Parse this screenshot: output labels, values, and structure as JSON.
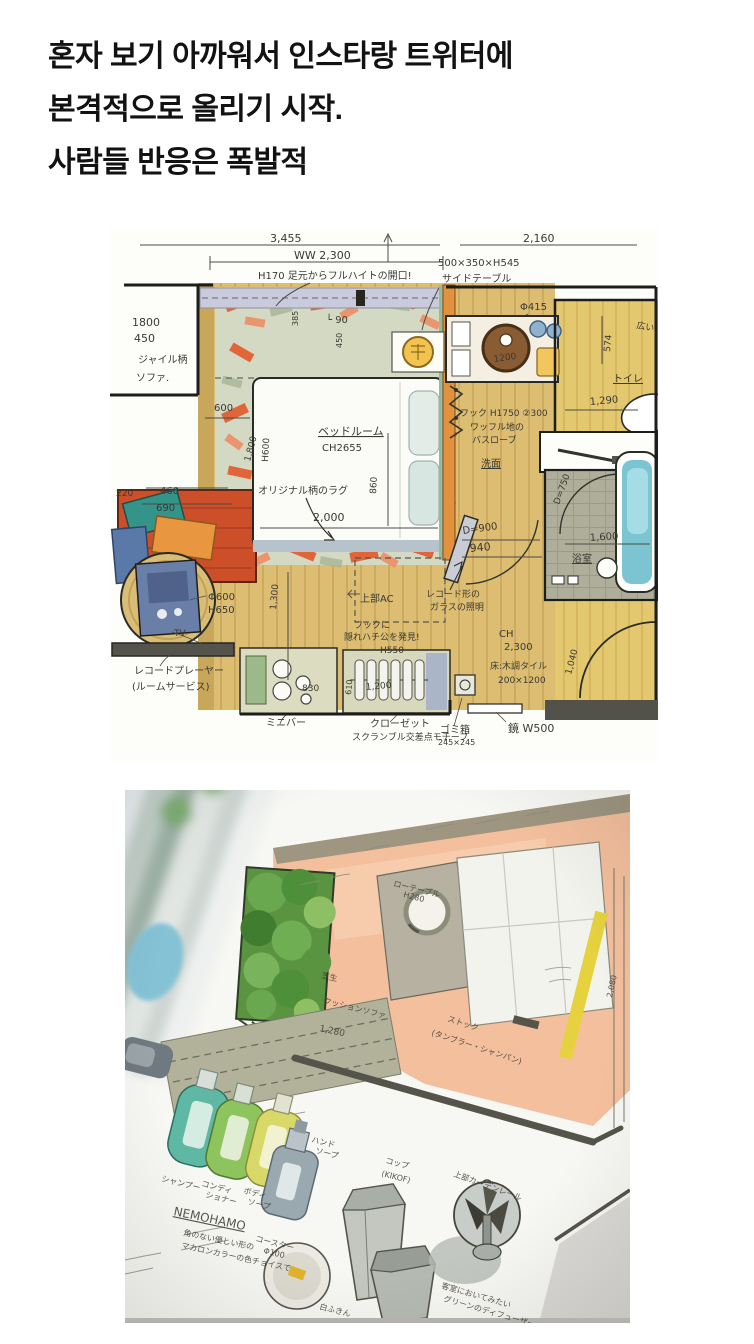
{
  "post": {
    "lines": [
      "혼자 보기 아까워서 인스타랑 트위터에",
      "본격적으로 올리기 시작.",
      "사람들 반응은 폭발적"
    ],
    "text_color": "#121212"
  },
  "plan1": {
    "description": "watercolor hotel guest-room floor plan, top-down",
    "palette": {
      "wood": "#dcbd72",
      "toilet_wood": "#e4c86f",
      "window_band": "#c9cbdc",
      "rug_base": "#d4d9c4",
      "rug_orange": "#e2592a",
      "sofa_red": "#cc4f2a",
      "tub_blue": "#7cc4d2",
      "tile": "#aeae9a",
      "stool_yellow": "#f2c65f",
      "player_blue": "#6a7fa8",
      "ink": "#2b2b26"
    },
    "annotations": [
      {
        "t": "3,455",
        "x": 160,
        "y": 14,
        "s": 11
      },
      {
        "t": "2,160",
        "x": 413,
        "y": 14,
        "s": 11
      },
      {
        "t": "WW 2,300",
        "x": 184,
        "y": 31,
        "s": 11
      },
      {
        "t": "500×350×H545",
        "x": 328,
        "y": 38,
        "s": 10
      },
      {
        "t": "サイドテーブル",
        "x": 332,
        "y": 54,
        "s": 10
      },
      {
        "t": "H170 足元からフルハイトの開口!",
        "x": 148,
        "y": 51,
        "s": 10
      },
      {
        "t": "385",
        "x": 188,
        "y": 98,
        "s": 8,
        "r": -90
      },
      {
        "t": "└ 90",
        "x": 216,
        "y": 95,
        "s": 10
      },
      {
        "t": "450",
        "x": 232,
        "y": 120,
        "s": 8,
        "r": -90
      },
      {
        "t": "1800",
        "x": 22,
        "y": 98,
        "s": 11
      },
      {
        "t": "450",
        "x": 24,
        "y": 114,
        "s": 11
      },
      {
        "t": "ジャイル柄",
        "x": 28,
        "y": 135,
        "s": 10
      },
      {
        "t": "ソファ.",
        "x": 26,
        "y": 153,
        "s": 10
      },
      {
        "t": "Φ415",
        "x": 410,
        "y": 82,
        "s": 10
      },
      {
        "t": "1200",
        "x": 384,
        "y": 134,
        "s": 9,
        "r": -8
      },
      {
        "t": "574",
        "x": 500,
        "y": 124,
        "s": 9,
        "r": -85
      },
      {
        "t": "広い",
        "x": 526,
        "y": 100,
        "s": 9,
        "r": 10
      },
      {
        "t": "トイレ",
        "x": 503,
        "y": 154,
        "s": 10,
        "u": 1
      },
      {
        "t": "1,290",
        "x": 480,
        "y": 177,
        "s": 10,
        "r": -5
      },
      {
        "t": "フック H1750 ②300",
        "x": 350,
        "y": 188,
        "s": 9
      },
      {
        "t": "ワッフル地の",
        "x": 360,
        "y": 202,
        "s": 9
      },
      {
        "t": "バスローブ",
        "x": 362,
        "y": 215,
        "s": 9
      },
      {
        "t": "洗面",
        "x": 371,
        "y": 239,
        "s": 10,
        "u": 1
      },
      {
        "t": "600",
        "x": 104,
        "y": 183,
        "s": 10
      },
      {
        "t": "1,800",
        "x": 140,
        "y": 234,
        "s": 9,
        "r": -75
      },
      {
        "t": "H600",
        "x": 158,
        "y": 234,
        "s": 9,
        "r": -87
      },
      {
        "t": "ベッドルーム",
        "x": 208,
        "y": 207,
        "s": 11,
        "u": 1
      },
      {
        "t": "CH2655",
        "x": 212,
        "y": 223,
        "s": 10
      },
      {
        "t": "860",
        "x": 266,
        "y": 266,
        "s": 9,
        "r": -87
      },
      {
        "t": "オリジナル柄のラグ",
        "x": 148,
        "y": 266,
        "s": 10
      },
      {
        "t": "2,000",
        "x": 203,
        "y": 293,
        "s": 11
      },
      {
        "t": "220",
        "x": 6,
        "y": 268,
        "s": 9
      },
      {
        "t": "460",
        "x": 50,
        "y": 266,
        "s": 10
      },
      {
        "t": "690",
        "x": 46,
        "y": 283,
        "s": 10
      },
      {
        "t": "Φ600",
        "x": 98,
        "y": 372,
        "s": 10
      },
      {
        "t": "H650",
        "x": 98,
        "y": 385,
        "s": 10
      },
      {
        "t": "TV",
        "x": 64,
        "y": 408,
        "s": 9
      },
      {
        "t": "レコードプレーヤー",
        "x": 24,
        "y": 446,
        "s": 10
      },
      {
        "t": "(ルームサービス)",
        "x": 22,
        "y": 462,
        "s": 10
      },
      {
        "t": "830",
        "x": 192,
        "y": 463,
        "s": 9
      },
      {
        "t": "ミニバー",
        "x": 156,
        "y": 498,
        "s": 10
      },
      {
        "t": "1,300",
        "x": 166,
        "y": 382,
        "s": 9,
        "r": -85
      },
      {
        "t": "上部AC",
        "x": 250,
        "y": 374,
        "s": 10
      },
      {
        "t": "フックに",
        "x": 244,
        "y": 400,
        "s": 9
      },
      {
        "t": "隠れハチ公を発見!",
        "x": 234,
        "y": 412,
        "s": 9
      },
      {
        "t": "H550",
        "x": 270,
        "y": 425,
        "s": 9
      },
      {
        "t": "610",
        "x": 241,
        "y": 467,
        "s": 8,
        "r": -85
      },
      {
        "t": "1,200",
        "x": 256,
        "y": 462,
        "s": 9,
        "r": -5
      },
      {
        "t": "クローゼット",
        "x": 260,
        "y": 499,
        "s": 10
      },
      {
        "t": "スクランブル交差点モチーフ",
        "x": 242,
        "y": 512,
        "s": 9
      },
      {
        "t": "ゴミ箱",
        "x": 330,
        "y": 505,
        "s": 10
      },
      {
        "t": "245×245",
        "x": 328,
        "y": 517,
        "s": 8
      },
      {
        "t": "鏡 W500",
        "x": 398,
        "y": 504,
        "s": 11
      },
      {
        "t": "CH",
        "x": 389,
        "y": 409,
        "s": 10
      },
      {
        "t": "2,300",
        "x": 394,
        "y": 422,
        "s": 10
      },
      {
        "t": "床:木調タイル",
        "x": 380,
        "y": 441,
        "s": 9
      },
      {
        "t": "200×1200",
        "x": 388,
        "y": 455,
        "s": 9
      },
      {
        "t": "1,040",
        "x": 461,
        "y": 447,
        "s": 9,
        "r": -75
      },
      {
        "t": "D=900",
        "x": 353,
        "y": 306,
        "s": 10,
        "r": -8
      },
      {
        "t": "940",
        "x": 360,
        "y": 324,
        "s": 11,
        "r": -5
      },
      {
        "t": "レコード形の",
        "x": 316,
        "y": 369,
        "s": 9
      },
      {
        "t": "ガラスの照明",
        "x": 320,
        "y": 382,
        "s": 9
      },
      {
        "t": "D=750",
        "x": 449,
        "y": 277,
        "s": 9,
        "r": -70
      },
      {
        "t": "1,600",
        "x": 480,
        "y": 313,
        "s": 10,
        "r": -4
      },
      {
        "t": "浴室",
        "x": 462,
        "y": 334,
        "s": 10,
        "u": 1
      }
    ]
  },
  "plan2": {
    "description": "angled photo of watercolor terrace plan with amenity sketches",
    "palette": {
      "terrace": "#f4bf9d",
      "garden": "#5a9440",
      "pond": "#85c2d6",
      "yellow_strip": "#e6d23e",
      "bottle_teal": "#5fb8a3",
      "bottle_green": "#8ec45e",
      "bottle_yellow": "#d9d96a",
      "bottle_gray": "#9aa8b0",
      "paper": "#f7f7f3"
    },
    "annotations": [
      {
        "t": "ローテーブル",
        "x": 268,
        "y": 96,
        "s": 8,
        "r": 14
      },
      {
        "t": "H280",
        "x": 278,
        "y": 107,
        "s": 8,
        "r": 14
      },
      {
        "t": "芝生",
        "x": 196,
        "y": 188,
        "s": 8,
        "r": 12
      },
      {
        "t": "クッションソファ",
        "x": 198,
        "y": 213,
        "s": 8,
        "r": 14
      },
      {
        "t": "1,280",
        "x": 194,
        "y": 241,
        "s": 9,
        "r": 12
      },
      {
        "t": "ストック",
        "x": 322,
        "y": 231,
        "s": 8,
        "r": 18
      },
      {
        "t": "(タンブラー・シャンパン)",
        "x": 306,
        "y": 245,
        "s": 8,
        "r": 18
      },
      {
        "t": "2,080",
        "x": 487,
        "y": 208,
        "s": 8,
        "r": -78
      },
      {
        "t": "上部カーテンレール",
        "x": 328,
        "y": 386,
        "s": 8,
        "r": 20
      },
      {
        "t": "シャンプー",
        "x": 36,
        "y": 391,
        "s": 8,
        "r": 14
      },
      {
        "t": "コンディ",
        "x": 76,
        "y": 396,
        "s": 8,
        "r": 14
      },
      {
        "t": "ショナー",
        "x": 80,
        "y": 407,
        "s": 8,
        "r": 14
      },
      {
        "t": "ボディ",
        "x": 118,
        "y": 403,
        "s": 8,
        "r": 14
      },
      {
        "t": "ソープ",
        "x": 122,
        "y": 414,
        "s": 8,
        "r": 14
      },
      {
        "t": "ハンド",
        "x": 186,
        "y": 352,
        "s": 8,
        "r": 14
      },
      {
        "t": "ソープ",
        "x": 190,
        "y": 363,
        "s": 8,
        "r": 14
      },
      {
        "t": "NEMOHAMO",
        "x": 48,
        "y": 425,
        "s": 12,
        "r": 12,
        "u": 1
      },
      {
        "t": "角のない優しい形の",
        "x": 58,
        "y": 445,
        "s": 8,
        "r": 12
      },
      {
        "t": "マカロンカラーの色チョイスで",
        "x": 56,
        "y": 458,
        "s": 8,
        "r": 12
      },
      {
        "t": "コースター",
        "x": 130,
        "y": 451,
        "s": 8,
        "r": 14
      },
      {
        "t": "Φ100",
        "x": 138,
        "y": 463,
        "s": 8,
        "r": 14
      },
      {
        "t": "白ふきん",
        "x": 194,
        "y": 519,
        "s": 8,
        "r": 14
      },
      {
        "t": "コップ",
        "x": 260,
        "y": 373,
        "s": 8,
        "r": 14
      },
      {
        "t": "(KIKOF)",
        "x": 256,
        "y": 386,
        "s": 8,
        "r": 14
      },
      {
        "t": "客室においてみたい",
        "x": 316,
        "y": 498,
        "s": 8,
        "r": 16
      },
      {
        "t": "グリーンのディフューザー",
        "x": 318,
        "y": 511,
        "s": 8,
        "r": 16
      }
    ]
  }
}
